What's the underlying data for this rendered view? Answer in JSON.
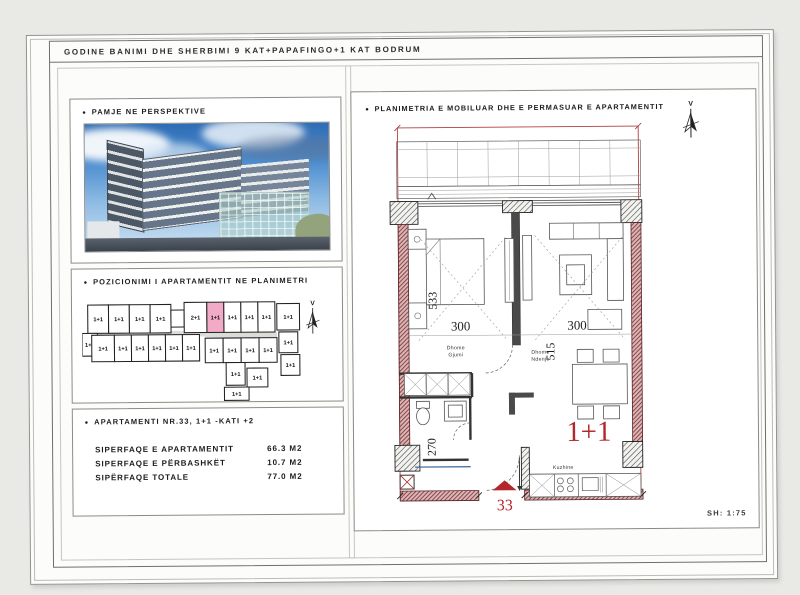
{
  "title_block": {
    "title": "GODINE BANIMI DHE SHERBIMI  9 KAT+PAPAFINGO+1 KAT BODRUM"
  },
  "perspective": {
    "bullet": "•",
    "label": "PAMJE NE PERSPEKTIVE"
  },
  "position": {
    "bullet": "•",
    "label": "POZICIONIMI I APARTAMENTIT NE PLANIMETRI",
    "compass_label": "V",
    "units": [
      {
        "label": "1+1",
        "x": 6,
        "y": 8,
        "w": 22,
        "h": 30
      },
      {
        "label": "1+1",
        "x": 28,
        "y": 8,
        "w": 22,
        "h": 30
      },
      {
        "label": "1+1",
        "x": 50,
        "y": 8,
        "w": 22,
        "h": 30
      },
      {
        "label": "1+1",
        "x": 72,
        "y": 8,
        "w": 22,
        "h": 30
      },
      {
        "label": "1+1",
        "x": 0,
        "y": 38,
        "w": 16,
        "h": 24
      },
      {
        "label": "",
        "x": 94,
        "y": 14,
        "w": 14,
        "h": 18
      },
      {
        "label": "2+1",
        "x": 108,
        "y": 6,
        "w": 24,
        "h": 32
      },
      {
        "label": "1+1",
        "x": 132,
        "y": 6,
        "w": 18,
        "h": 32,
        "hl": true
      },
      {
        "label": "1+1",
        "x": 150,
        "y": 6,
        "w": 18,
        "h": 32
      },
      {
        "label": "1+1",
        "x": 168,
        "y": 6,
        "w": 18,
        "h": 32
      },
      {
        "label": "1+1",
        "x": 186,
        "y": 6,
        "w": 18,
        "h": 32
      },
      {
        "label": "1+1",
        "x": 206,
        "y": 8,
        "w": 24,
        "h": 28
      },
      {
        "label": "1+1",
        "x": 10,
        "y": 40,
        "w": 24,
        "h": 28
      },
      {
        "label": "1+1",
        "x": 34,
        "y": 40,
        "w": 18,
        "h": 28
      },
      {
        "label": "1+1",
        "x": 52,
        "y": 40,
        "w": 18,
        "h": 28
      },
      {
        "label": "1+1",
        "x": 70,
        "y": 40,
        "w": 18,
        "h": 28
      },
      {
        "label": "1+1",
        "x": 88,
        "y": 40,
        "w": 18,
        "h": 28
      },
      {
        "label": "1+1",
        "x": 106,
        "y": 40,
        "w": 18,
        "h": 28
      },
      {
        "label": "1+1",
        "x": 130,
        "y": 44,
        "w": 19,
        "h": 26
      },
      {
        "label": "1+1",
        "x": 149,
        "y": 44,
        "w": 19,
        "h": 26
      },
      {
        "label": "1+1",
        "x": 168,
        "y": 44,
        "w": 19,
        "h": 26
      },
      {
        "label": "1+1",
        "x": 187,
        "y": 44,
        "w": 19,
        "h": 26
      },
      {
        "label": "1+1",
        "x": 208,
        "y": 38,
        "w": 20,
        "h": 22
      },
      {
        "label": "1+1",
        "x": 210,
        "y": 62,
        "w": 20,
        "h": 22
      },
      {
        "label": "1+1",
        "x": 152,
        "y": 70,
        "w": 20,
        "h": 24
      },
      {
        "label": "1+1",
        "x": 174,
        "y": 76,
        "w": 22,
        "h": 20
      },
      {
        "label": "1+1",
        "x": 150,
        "y": 96,
        "w": 26,
        "h": 14
      }
    ]
  },
  "apartment_info": {
    "bullet": "•",
    "title": "APARTAMENTI NR.33,  1+1 -KATI +2",
    "rows": [
      {
        "label": "SIPERFAQE E APARTAMENTIT",
        "value": "66.3 M2"
      },
      {
        "label": "SIPERFAQE E PËRBASHKËT",
        "value": "10.7 M2"
      },
      {
        "label": "SIPËRFAQE TOTALE",
        "value": "77.0 M2"
      }
    ]
  },
  "plan": {
    "bullet": "•",
    "label": "PLANIMETRIA E MOBILUAR DHE E PERMASUAR E APARTAMENTIT",
    "compass_label": "V",
    "scale_label": "SH: 1:75",
    "unit_type_label": "1+1",
    "apartment_number": "33",
    "rooms": {
      "bedroom": {
        "line1": "Dhome",
        "line2": "Gjumi"
      },
      "living": {
        "line1": "Dhome",
        "line2": "Ndenje"
      },
      "kitchen": "Kuzhine"
    },
    "dims": {
      "bedroom_width": "300",
      "living_width": "300",
      "bedroom_depth": "533",
      "living_depth": "515",
      "hall": "270"
    }
  },
  "colors": {
    "accent_red": "#b3262a",
    "wall_red": "#7c2a33",
    "highlight_pink": "#f2abc6",
    "plan_line": "#333333",
    "blue_line": "#4a6fa5"
  }
}
